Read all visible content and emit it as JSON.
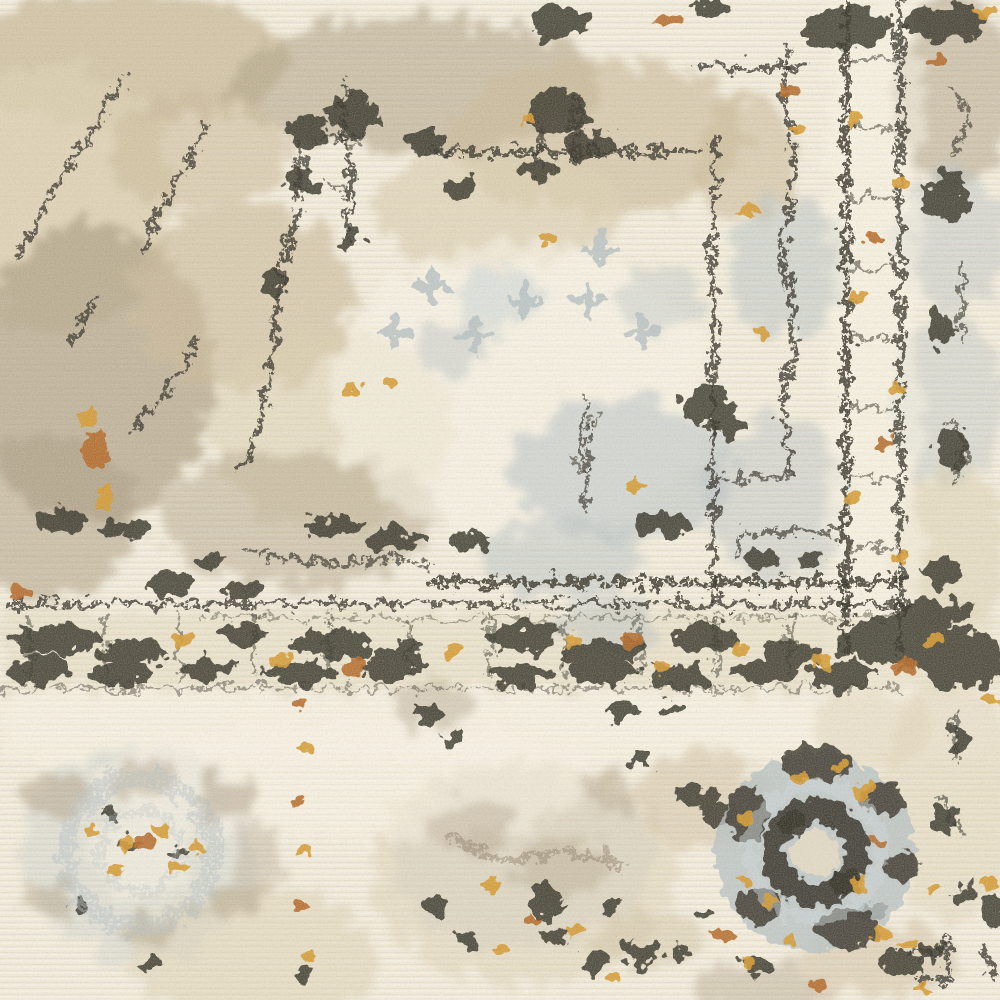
{
  "meta": {
    "type": "photograph",
    "subject": "Distressed vintage-style area rug, close-up detail",
    "aria_label": "Close-up of a cream, beige, gray-blue and charcoal distressed oriental-style rug with scattered gold and rust flecks",
    "description": "Overhead close-up of a power-loomed rug with a faded traditional medallion-and-border design. Ivory cut-pile ground with horizontal weave ridges, taupe and beige abrash washes across the upper left, charcoal stitched medallion outlines, small gray-blue cross and star motifs, a guard-stripe border running horizontally below center and a matching vertical border band at right meeting in a dark corner, a circular gray-blue and charcoal rosette at lower right with a faded twin rosette at lower left, and gold and rust flecks scattered throughout."
  },
  "palette": {
    "cream": "#efe8d6",
    "cream_light": "#f7f2e4",
    "cream_dark": "#e2d8c2",
    "beige": "#d9cdaf",
    "sand": "#c9b998",
    "taupe": "#ab9c81",
    "taupe_dark": "#8d8069",
    "grayblue": "#b5bfc1",
    "grayblue_light": "#ccd4d3",
    "charcoal": "#39352b",
    "charcoal_soft": "#56503e",
    "gold": "#d39a30",
    "rust": "#b36b2a"
  },
  "scene": {
    "weave_direction": "horizontal",
    "finish": "distressed cut pile",
    "regions": [
      {
        "name": "abrash-field",
        "desc": "mottled taupe/beige wash over the upper-left field"
      },
      {
        "name": "medallion-outline",
        "desc": "charcoal stepped diagonal and stitched outlines of the central medallion, upper middle"
      },
      {
        "name": "medallion-motifs",
        "desc": "small gray-blue crosses, sprigs and patches inside the cream medallion"
      },
      {
        "name": "inner-guard-lines",
        "desc": "broken charcoal verticals near x 714 and x 788 bounding the field"
      },
      {
        "name": "right-border-band",
        "desc": "vertical border pair of charcoal chain lines with gold accents near x 846-900"
      },
      {
        "name": "outer-right-motifs",
        "desc": "gray-blue and taupe half motifs along the right edge"
      },
      {
        "name": "horizontal-guard-band",
        "desc": "dark rule at y 604 with a blotched motif band to y 690 crossing the full width"
      },
      {
        "name": "border-corner",
        "desc": "dense charcoal corner mass where the two border bands meet, right of center"
      },
      {
        "name": "rosette-medallion",
        "desc": "circular rosette lower right: cream core, charcoal ring, gray-blue disc, outer charcoal arcs, gold halo"
      },
      {
        "name": "faded-rosette",
        "desc": "washed-out gray-blue ring rosette with gold flecks, lower left"
      },
      {
        "name": "accent-flecks",
        "desc": "gold and rust speckles scattered along borders and motifs"
      }
    ]
  }
}
